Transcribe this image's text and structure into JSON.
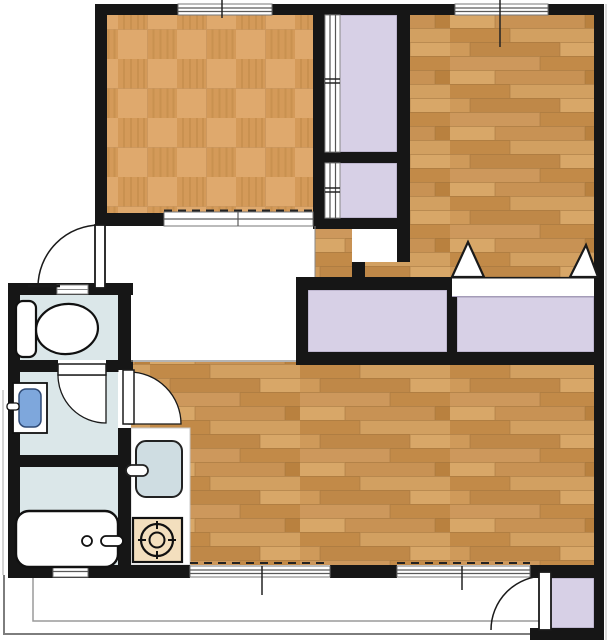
{
  "palette": {
    "wall": "#161616",
    "closet": "#d7d0e6",
    "closet_edge": "#a49cb8",
    "wet_floor": "#dbe7e9",
    "basin_blue": "#7ea7dc",
    "sink_grey": "#cfdde2",
    "stove_tan": "#f3dfbe",
    "tatami_light": "#dfa96d",
    "tatami_dark": "#d49a59",
    "wood_base": "#cd985c",
    "window_line": "#5a5a5a",
    "rail_grey": "#7d7d7d",
    "fixture_stroke": "#111111",
    "white": "#ffffff"
  },
  "fixtures": {
    "toilet": "toilet-fixture",
    "washbasin": "washbasin-fixture",
    "bathtub": "bathtub-fixture",
    "kitchen_sink": "kitchen-sink-fixture",
    "stove": "gas-burner-fixture"
  }
}
